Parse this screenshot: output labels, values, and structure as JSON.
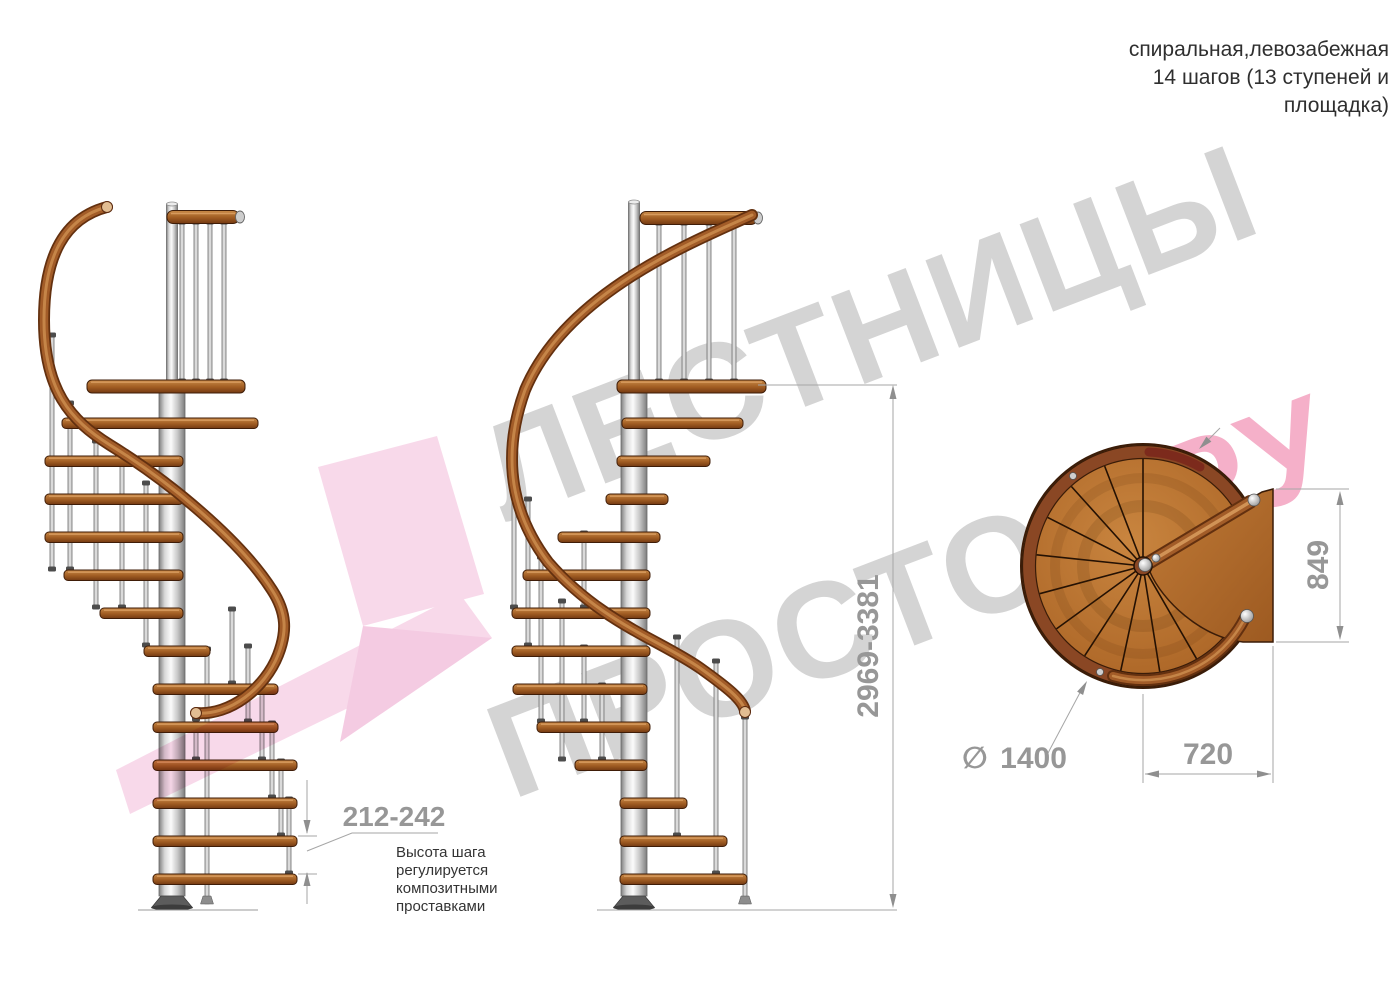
{
  "title_block": {
    "line1": "спиральная,левозабежная",
    "line2": "14 шагов (13 ступеней и",
    "line3": "площадка)"
  },
  "dimensions": {
    "total_height": "2969-3381",
    "step_height": "212-242",
    "diameter_symbol": "∅",
    "diameter_value": "1400",
    "plan_width": "720",
    "plan_depth": "849"
  },
  "step_note": {
    "line1": "Высота шага",
    "line2": "регулируется",
    "line3": "композитными",
    "line4": "проставками"
  },
  "watermark": {
    "word1": "ЛЕСТНИЦЫ",
    "word2": "ПРОСТО",
    "dot": ".",
    "domain": "РУ"
  },
  "palette": {
    "wood": "#a96327",
    "wood_dark": "#3f1d08",
    "handrail": "#a25c28",
    "metal": "#c9c9c9",
    "dimension_gray": "#979797",
    "watermark_gray": "#d4d4d4",
    "brand_pink": "#f5b0c9",
    "logo_pink": "#f7d3e7"
  }
}
